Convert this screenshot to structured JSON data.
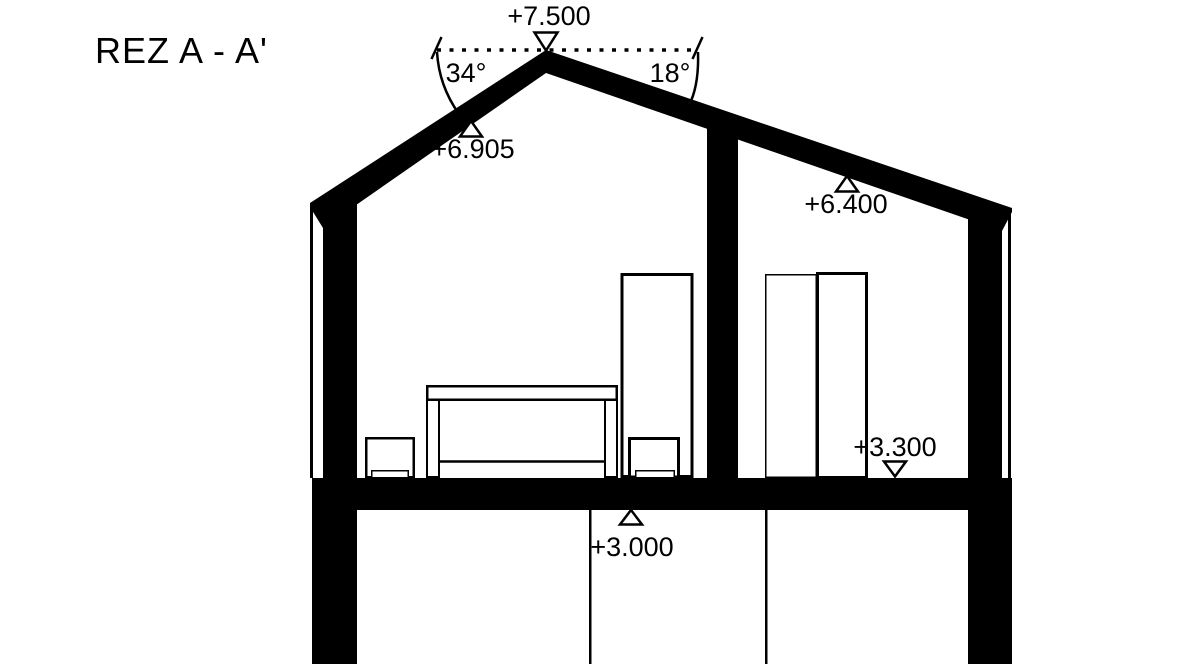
{
  "title": "REZ A - A'",
  "colors": {
    "ink": "#000000",
    "paper": "#ffffff"
  },
  "levels": {
    "ridge": "+7.500",
    "left_roof": "+6.905",
    "right_roof": "+6.400",
    "upper_floor": "+3.300",
    "slab": "+3.000"
  },
  "angles": {
    "left_pitch": "34°",
    "right_pitch": "18°"
  }
}
